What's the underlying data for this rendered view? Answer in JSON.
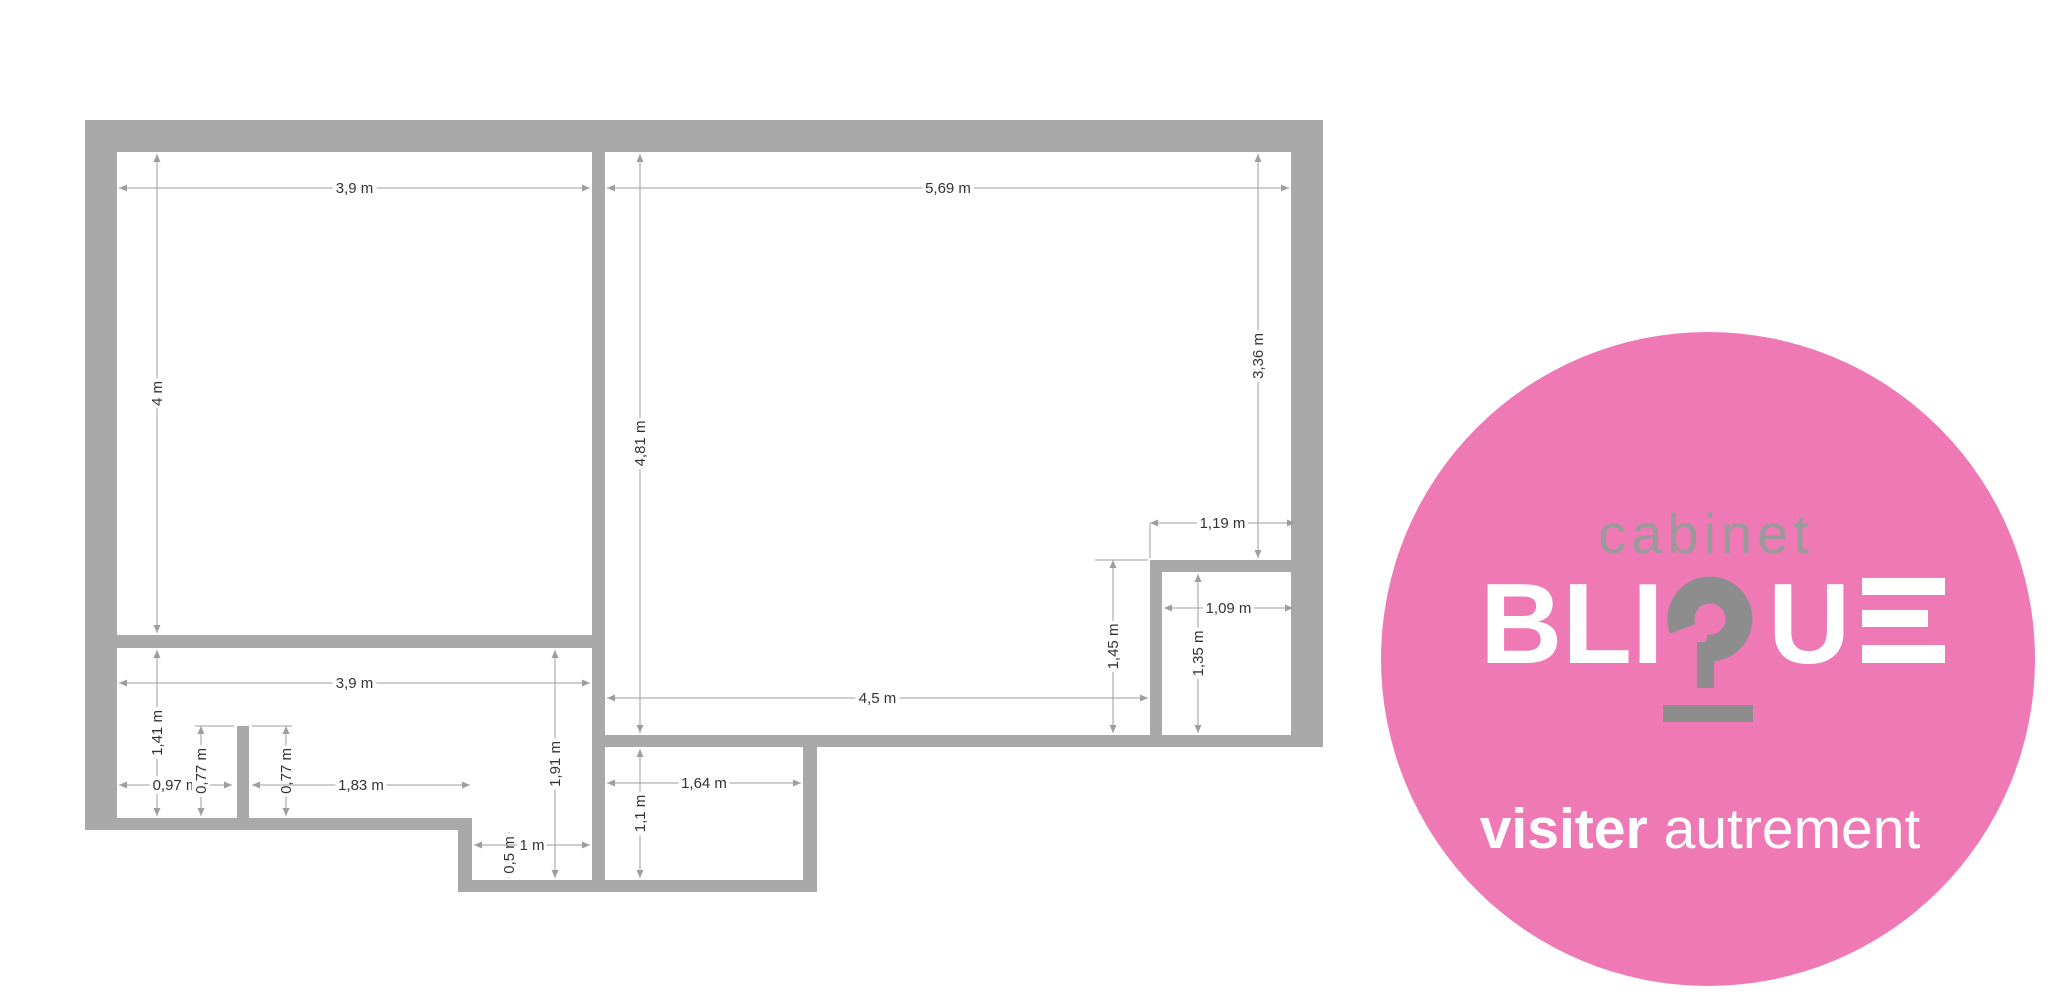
{
  "floor_plan": {
    "unit": "m",
    "wall_color": "#a9a9a9",
    "dim_line_color": "#9e9e9e",
    "dim_text_color": "#333333",
    "dimensions": [
      {
        "label": "3,9 m",
        "orient": "h",
        "pos": 188,
        "from": 119,
        "to": 590
      },
      {
        "label": "5,69 m",
        "orient": "h",
        "pos": 188,
        "from": 607,
        "to": 1289
      },
      {
        "label": "4 m",
        "orient": "v",
        "pos": 157,
        "from": 154,
        "to": 633
      },
      {
        "label": "4,81 m",
        "orient": "v",
        "pos": 640,
        "from": 154,
        "to": 733
      },
      {
        "label": "3,36 m",
        "orient": "v",
        "pos": 1258,
        "from": 154,
        "to": 558
      },
      {
        "label": "1,19 m",
        "orient": "h",
        "pos": 523,
        "from": 1150,
        "to": 1295
      },
      {
        "label": "1,09 m",
        "orient": "h",
        "pos": 608,
        "from": 1164,
        "to": 1293
      },
      {
        "label": "1,35 m",
        "orient": "v",
        "pos": 1198,
        "from": 574,
        "to": 733
      },
      {
        "label": "1,45 m",
        "orient": "v",
        "pos": 1113,
        "from": 560,
        "to": 733
      },
      {
        "label": "4,5 m",
        "orient": "h",
        "pos": 698,
        "from": 607,
        "to": 1148
      },
      {
        "label": "3,9 m",
        "orient": "h",
        "pos": 683,
        "from": 119,
        "to": 590
      },
      {
        "label": "1,41 m",
        "orient": "v",
        "pos": 157,
        "from": 650,
        "to": 816
      },
      {
        "label": "0,97 m",
        "orient": "h",
        "pos": 785,
        "from": 119,
        "to": 232
      },
      {
        "label": "0,77 m",
        "orient": "v",
        "pos": 201,
        "from": 726,
        "to": 816
      },
      {
        "label": "0,77 m",
        "orient": "v",
        "pos": 286,
        "from": 726,
        "to": 816
      },
      {
        "label": "1,83 m",
        "orient": "h",
        "pos": 785,
        "from": 252,
        "to": 470
      },
      {
        "label": "1,91 m",
        "orient": "v",
        "pos": 555,
        "from": 650,
        "to": 878
      },
      {
        "label": "0,5 m",
        "orient": "v",
        "pos": 509,
        "from": 832,
        "to": 878
      },
      {
        "label": "1 m",
        "orient": "h",
        "pos": 845,
        "from": 474,
        "to": 590
      },
      {
        "label": "1,1 m",
        "orient": "v",
        "pos": 640,
        "from": 749,
        "to": 878
      },
      {
        "label": "1,64 m",
        "orient": "h",
        "pos": 783,
        "from": 607,
        "to": 801
      }
    ],
    "extension_ticks": [
      {
        "x1": 195,
        "y1": 726,
        "x2": 234,
        "y2": 726
      },
      {
        "x1": 252,
        "y1": 726,
        "x2": 292,
        "y2": 726
      },
      {
        "x1": 1150,
        "y1": 523,
        "x2": 1150,
        "y2": 558
      },
      {
        "x1": 1095,
        "y1": 560,
        "x2": 1148,
        "y2": 560
      }
    ]
  },
  "logo": {
    "circle_color": "#ee79b4",
    "cabinet_label": "cabinet",
    "cabinet_color": "#9a9a9a",
    "brand_name": "BLIQUE",
    "brand_segment_pre": "BLI",
    "brand_segment_post": "U",
    "brand_accent_color": "#8d8d8d",
    "brand_text_color": "#ffffff",
    "tagline_bold": "visiter",
    "tagline_regular": "autrement"
  }
}
